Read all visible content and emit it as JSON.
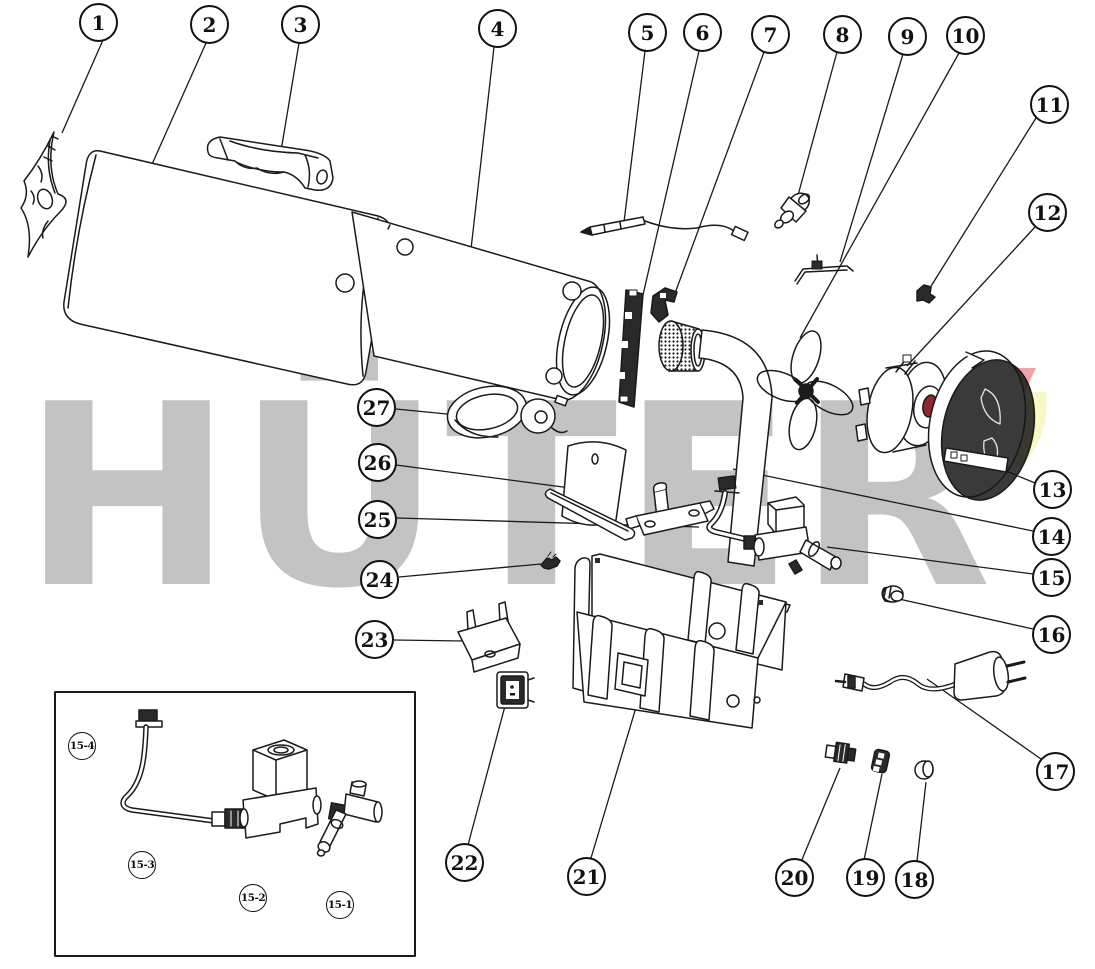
{
  "diagram": {
    "watermark": "HÜTER",
    "colors": {
      "line": "#1a1a1a",
      "watermark_gray": "#c3c3c3",
      "logo_red": "#f2a2a6",
      "logo_yellow": "#f8f8c4",
      "background": "#ffffff"
    },
    "callouts": [
      {
        "label": "1"
      },
      {
        "label": "2"
      },
      {
        "label": "3"
      },
      {
        "label": "4"
      },
      {
        "label": "5"
      },
      {
        "label": "6"
      },
      {
        "label": "7"
      },
      {
        "label": "8"
      },
      {
        "label": "9"
      },
      {
        "label": "10"
      },
      {
        "label": "11"
      },
      {
        "label": "12"
      },
      {
        "label": "13"
      },
      {
        "label": "14"
      },
      {
        "label": "15"
      },
      {
        "label": "16"
      },
      {
        "label": "17"
      },
      {
        "label": "18"
      },
      {
        "label": "19"
      },
      {
        "label": "20"
      },
      {
        "label": "21"
      },
      {
        "label": "22"
      },
      {
        "label": "23"
      },
      {
        "label": "24"
      },
      {
        "label": "25"
      },
      {
        "label": "26"
      },
      {
        "label": "27"
      }
    ],
    "inset_callouts": [
      {
        "label": "15-4"
      },
      {
        "label": "15-3"
      },
      {
        "label": "15-2"
      },
      {
        "label": "15-1"
      }
    ]
  }
}
